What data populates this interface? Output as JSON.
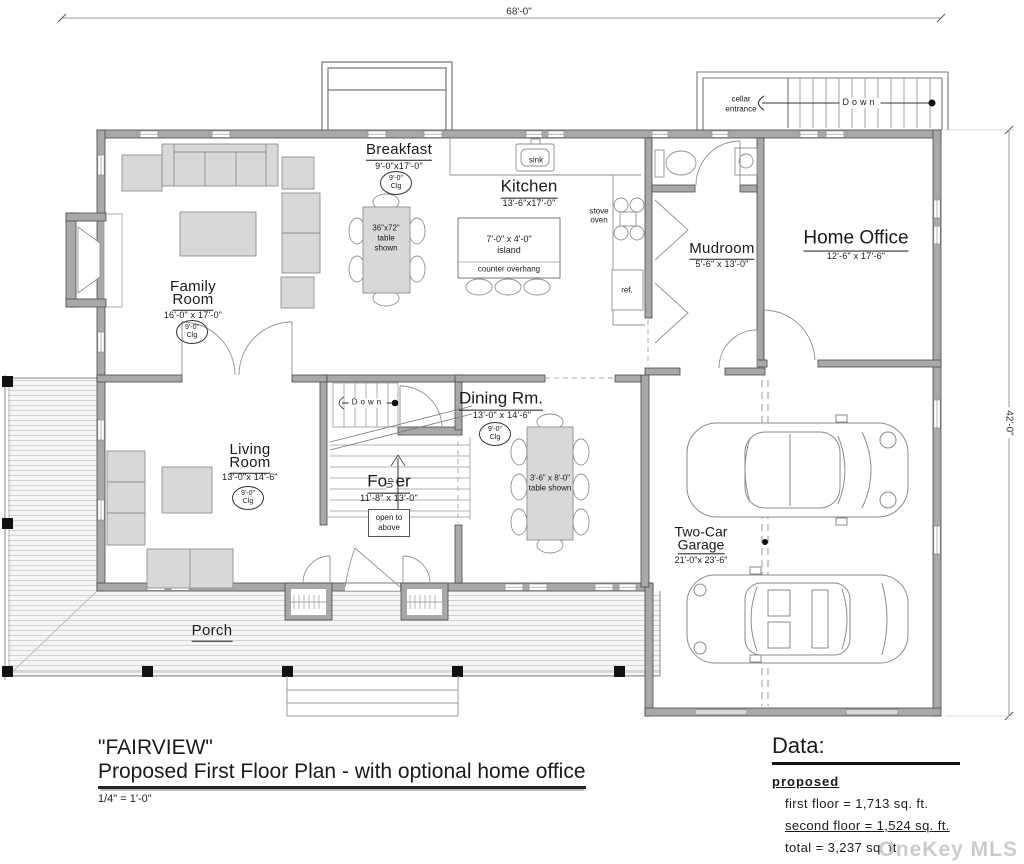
{
  "dimensions": {
    "width_label": "68'-0\"",
    "height_label": "42'-0\""
  },
  "cellar": {
    "label_line1": "cellar",
    "label_line2": "entrance",
    "down_label": "Down"
  },
  "stairs": {
    "down": "Down",
    "up": "Up"
  },
  "rooms": {
    "breakfast": {
      "name": "Breakfast",
      "dims": "9'-0\"x17'-0\"",
      "clg1": "9'-0\"",
      "clg2": "Clg",
      "table_line1": "36\"x72\"",
      "table_line2": "table",
      "table_line3": "shown"
    },
    "kitchen": {
      "name": "Kitchen",
      "dims": "13'-6\"x17'-0\"",
      "sink": "sink",
      "stove1": "stove",
      "stove2": "oven",
      "ref": "ref.",
      "island_line1": "7'-0\" x 4'-0\"",
      "island_line2": "island",
      "overhang": "counter overhang"
    },
    "family": {
      "name_line1": "Family",
      "name_line2": "Room",
      "dims": "16'-0\" x 17'-0\"",
      "clg1": "9'-0\"",
      "clg2": "Clg"
    },
    "mudroom": {
      "name": "Mudroom",
      "dims": "5'-6\" x 13'-0\""
    },
    "home_office": {
      "name": "Home Office",
      "dims": "12'-6\" x 17'-6\""
    },
    "living": {
      "name_line1": "Living",
      "name_line2": "Room",
      "dims": "13'-0\"x 14'-6\"",
      "clg1": "9'-0\"",
      "clg2": "Clg"
    },
    "foyer": {
      "name": "Foyer",
      "dims": "11'-8\" x 13'-0\"",
      "open_line1": "open to",
      "open_line2": "above"
    },
    "dining": {
      "name": "Dining Rm.",
      "dims": "13'-0\" x 14'-6\"",
      "clg1": "9'-0\"",
      "clg2": "Clg",
      "table_line1": "3'-6\" x 8'-0\"",
      "table_line2": "table shown"
    },
    "garage": {
      "name_line1": "Two-Car",
      "name_line2": "Garage",
      "dims": "21'-0\"x 23'-6\""
    },
    "porch": {
      "name": "Porch"
    }
  },
  "title_block": {
    "name": "\"FAIRVIEW\"",
    "subtitle": "Proposed First Floor Plan - with optional home office",
    "scale": "1/4\" = 1'-0\""
  },
  "data_block": {
    "heading": "Data:",
    "status": "proposed",
    "first_floor": "first floor = 1,713 sq. ft.",
    "second_floor": "second floor = 1,524 sq. ft.",
    "total": "total = 3,237 sq. ft.",
    "garage": "garage = 523 sq. ft."
  },
  "watermark": "OneKey MLS"
}
